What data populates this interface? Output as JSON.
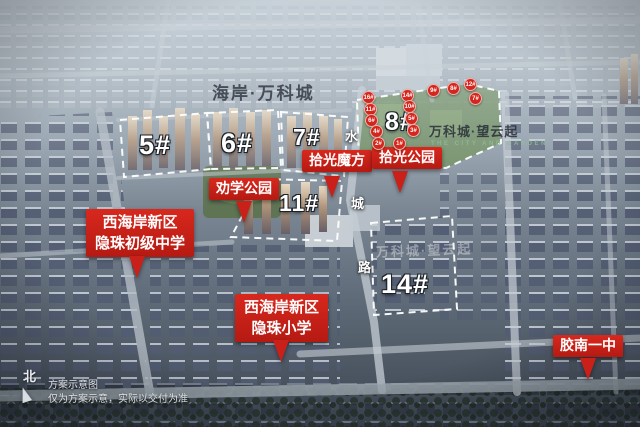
{
  "watermarks": {
    "estate_name": "海岸·万科城",
    "project_name": "万科城·望云起",
    "project_name_en": "THE CITY AND GARDEN",
    "project_name_faint": "万科城·望云起"
  },
  "parcels": [
    {
      "label": "5#"
    },
    {
      "label": "6#"
    },
    {
      "label": "7#"
    },
    {
      "label": "8#"
    },
    {
      "label": "11#"
    },
    {
      "label": "14#"
    }
  ],
  "badges": {
    "quanxue_park": {
      "label": "劝学公园"
    },
    "shiguang_mofang": {
      "label": "拾光魔方"
    },
    "shiguang_park": {
      "label": "拾光公园"
    },
    "yinzhu_middle_school": {
      "line1": "西海岸新区",
      "line2": "隐珠初级中学"
    },
    "yinzhu_primary_school": {
      "line1": "西海岸新区",
      "line2": "隐珠小学"
    },
    "jiaonan_no1_school": {
      "label": "胶南一中"
    }
  },
  "building_markers": [
    "16#",
    "14#",
    "9#",
    "8#",
    "12#",
    "7#",
    "11#",
    "10#",
    "6#",
    "5#",
    "4#",
    "3#",
    "2#",
    "1#"
  ],
  "road": {
    "chars": [
      "水",
      "城",
      "路"
    ]
  },
  "compass": {
    "label": "北"
  },
  "disclaimer": {
    "line1": "方案示意图",
    "line2": "仅为方案示意，实际以交付为准"
  },
  "colors": {
    "badge_red": "#d2251c",
    "dash_white": "#ffffff",
    "park_green": "#6d8c5c"
  }
}
